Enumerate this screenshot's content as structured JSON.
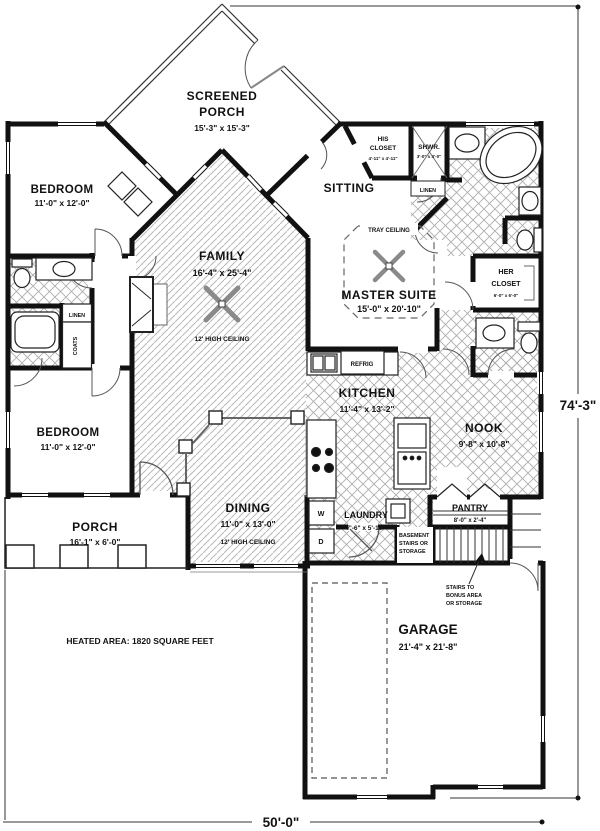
{
  "plan": {
    "screened_porch": {
      "line1": "SCREENED",
      "line2": "PORCH",
      "dims": "15'-3\" x 15'-3\""
    },
    "bedroom_upper": {
      "name": "BEDROOM",
      "dims": "11'-0\" x 12'-0\""
    },
    "bedroom_lower": {
      "name": "BEDROOM",
      "dims": "11'-0\" x 12'-0\""
    },
    "family": {
      "name": "FAMILY",
      "dims": "16'-4\" x 25'-4\"",
      "note": "12' HIGH CEILING"
    },
    "sitting": {
      "name": "SITTING"
    },
    "master_suite": {
      "name": "MASTER SUITE",
      "dims": "15'-0\" x 20'-10\"",
      "ceiling": "TRAY CEILING"
    },
    "his_closet": {
      "line1": "HIS",
      "line2": "CLOSET",
      "dims": "4'-11\" x 4'-11\""
    },
    "shower": {
      "name": "SHWR.",
      "dims": "3'-0\" x 4'-0\""
    },
    "linen_upper": {
      "name": "LINEN"
    },
    "linen_hall": {
      "name": "LINEN"
    },
    "coats": {
      "name": "COATS"
    },
    "her_closet": {
      "line1": "HER",
      "line2": "CLOSET",
      "dims": "6'-0\" x 6'-0\""
    },
    "kitchen": {
      "name": "KITCHEN",
      "dims": "11'-4\" x 13'-2\""
    },
    "refrig": {
      "name": "REFRIG"
    },
    "nook": {
      "name": "NOOK",
      "dims": "9'-8\" x 10'-8\""
    },
    "dining": {
      "name": "DINING",
      "dims": "11'-0\" x 13'-0\"",
      "note": "12' HIGH CEILING"
    },
    "porch": {
      "name": "PORCH",
      "dims": "16'-1\" x 6'-0\""
    },
    "laundry": {
      "name": "LAUNDRY",
      "dims": "7'-6\" x 5'-10\"",
      "washer": "W",
      "dryer": "D"
    },
    "pantry": {
      "name": "PANTRY",
      "dims": "8'-0\" x 2'-4\""
    },
    "basement_stairs": {
      "line1": "BASEMENT",
      "line2": "STAIRS OR",
      "line3": "STORAGE"
    },
    "stairs_note": {
      "line1": "STAIRS TO",
      "line2": "BONUS AREA",
      "line3": "OR STORAGE"
    },
    "garage": {
      "name": "GARAGE",
      "dims": "21'-4\" x 21'-8\""
    }
  },
  "annotations": {
    "heated_area": "HEATED AREA: 1820 SQUARE FEET",
    "overall_depth": "74'-3\"",
    "overall_width": "50'-0\""
  },
  "colors": {
    "wall": "#111111",
    "hatch": "#b8b8b8",
    "tile": "#adadad"
  }
}
